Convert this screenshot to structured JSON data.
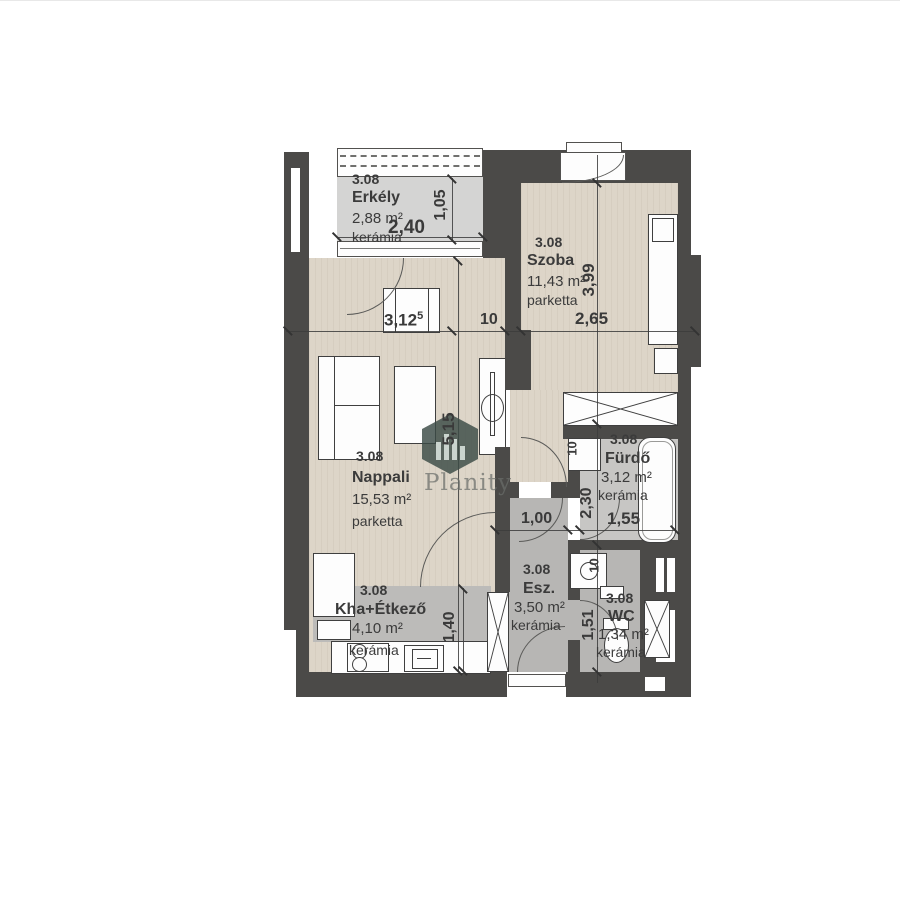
{
  "plan_title": "Apartment floor plan 3.08",
  "watermark": {
    "brand": "Planity"
  },
  "rooms": [
    {
      "id": "erkely",
      "number": "3.08",
      "name": "Erkély",
      "area": "2,88 m²",
      "floor": "kerámia"
    },
    {
      "id": "szoba",
      "number": "3.08",
      "name": "Szoba",
      "area": "11,43 m²",
      "floor": "parketta"
    },
    {
      "id": "nappali",
      "number": "3.08",
      "name": "Nappali",
      "area": "15,53 m²",
      "floor": "parketta"
    },
    {
      "id": "kha",
      "number": "3.08",
      "name": "Kha+Étkező",
      "area": "4,10 m²",
      "floor": "kerámia"
    },
    {
      "id": "esz",
      "number": "3.08",
      "name": "Esz.",
      "area": "3,50 m²",
      "floor": "kerámia"
    },
    {
      "id": "furdo",
      "number": "3.08",
      "name": "Fürdő",
      "area": "3,12 m²",
      "floor": "kerámia"
    },
    {
      "id": "wc",
      "number": "3.08",
      "name": "WC",
      "area": "1,34 m²",
      "floor": "kerámia"
    }
  ],
  "dimensions": {
    "balcony_width": "2,40",
    "balcony_depth": "1,05",
    "nappali_width": "3,12",
    "nappali_width_sup": "5",
    "wall_t1": "10",
    "szoba_width": "2,65",
    "szoba_depth": "3,99",
    "nappali_depth": "5,15",
    "esz_width": "1,00",
    "furdo_depth": "2,30",
    "furdo_width": "1,55",
    "kitchen_depth": "1,40",
    "wc_depth": "1,51",
    "wall_t2": "10",
    "wall_t3": "10"
  },
  "colors": {
    "wall": "#4b4a48",
    "parketta_floor": "#ddd5c8",
    "ceramic_light": "#d4d4d3",
    "ceramic_grey": "#b7b6b4",
    "background": "#ffffff"
  }
}
